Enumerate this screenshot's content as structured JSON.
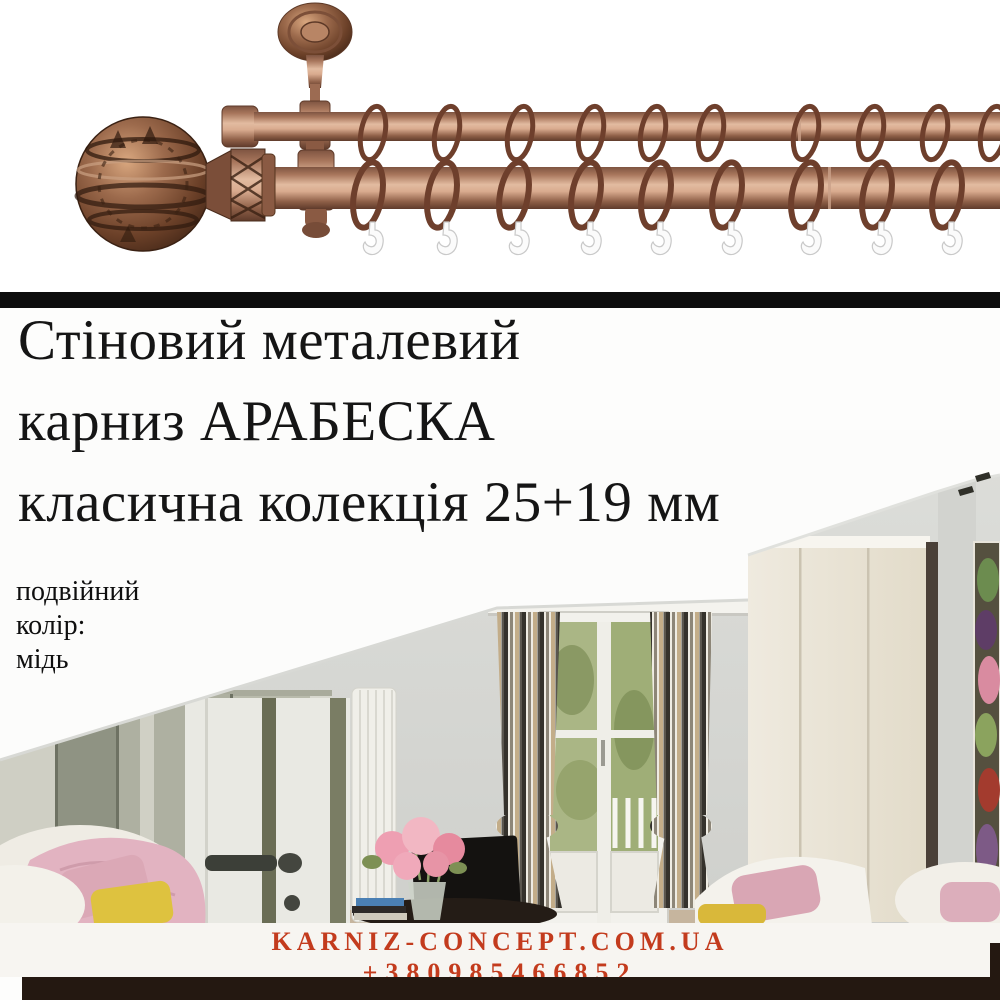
{
  "headline": {
    "line1": "Стіновий металевий",
    "line2": "карниз АРАБЕСКА",
    "line3": "класична колекція 25+19 мм"
  },
  "specs": {
    "type": "подвійний",
    "color_label": "колір:",
    "color_value": "мідь"
  },
  "footer": {
    "website": "KARNIZ-CONCEPT.COM.UA",
    "phone": "+380985466852"
  },
  "product_photo": {
    "description": "подвійний мідний карниз: декоративний наконечник, настінний кронштейн, кільця з гачками"
  },
  "room_photo": {
    "description": "мансардна кімната зі смугастими шторами на балконних дверях"
  },
  "colors": {
    "accent_text": "#c33b1d",
    "divider_bar": "#0d0d0d",
    "bottom_bar": "#241811",
    "copper": "#b5826a"
  }
}
